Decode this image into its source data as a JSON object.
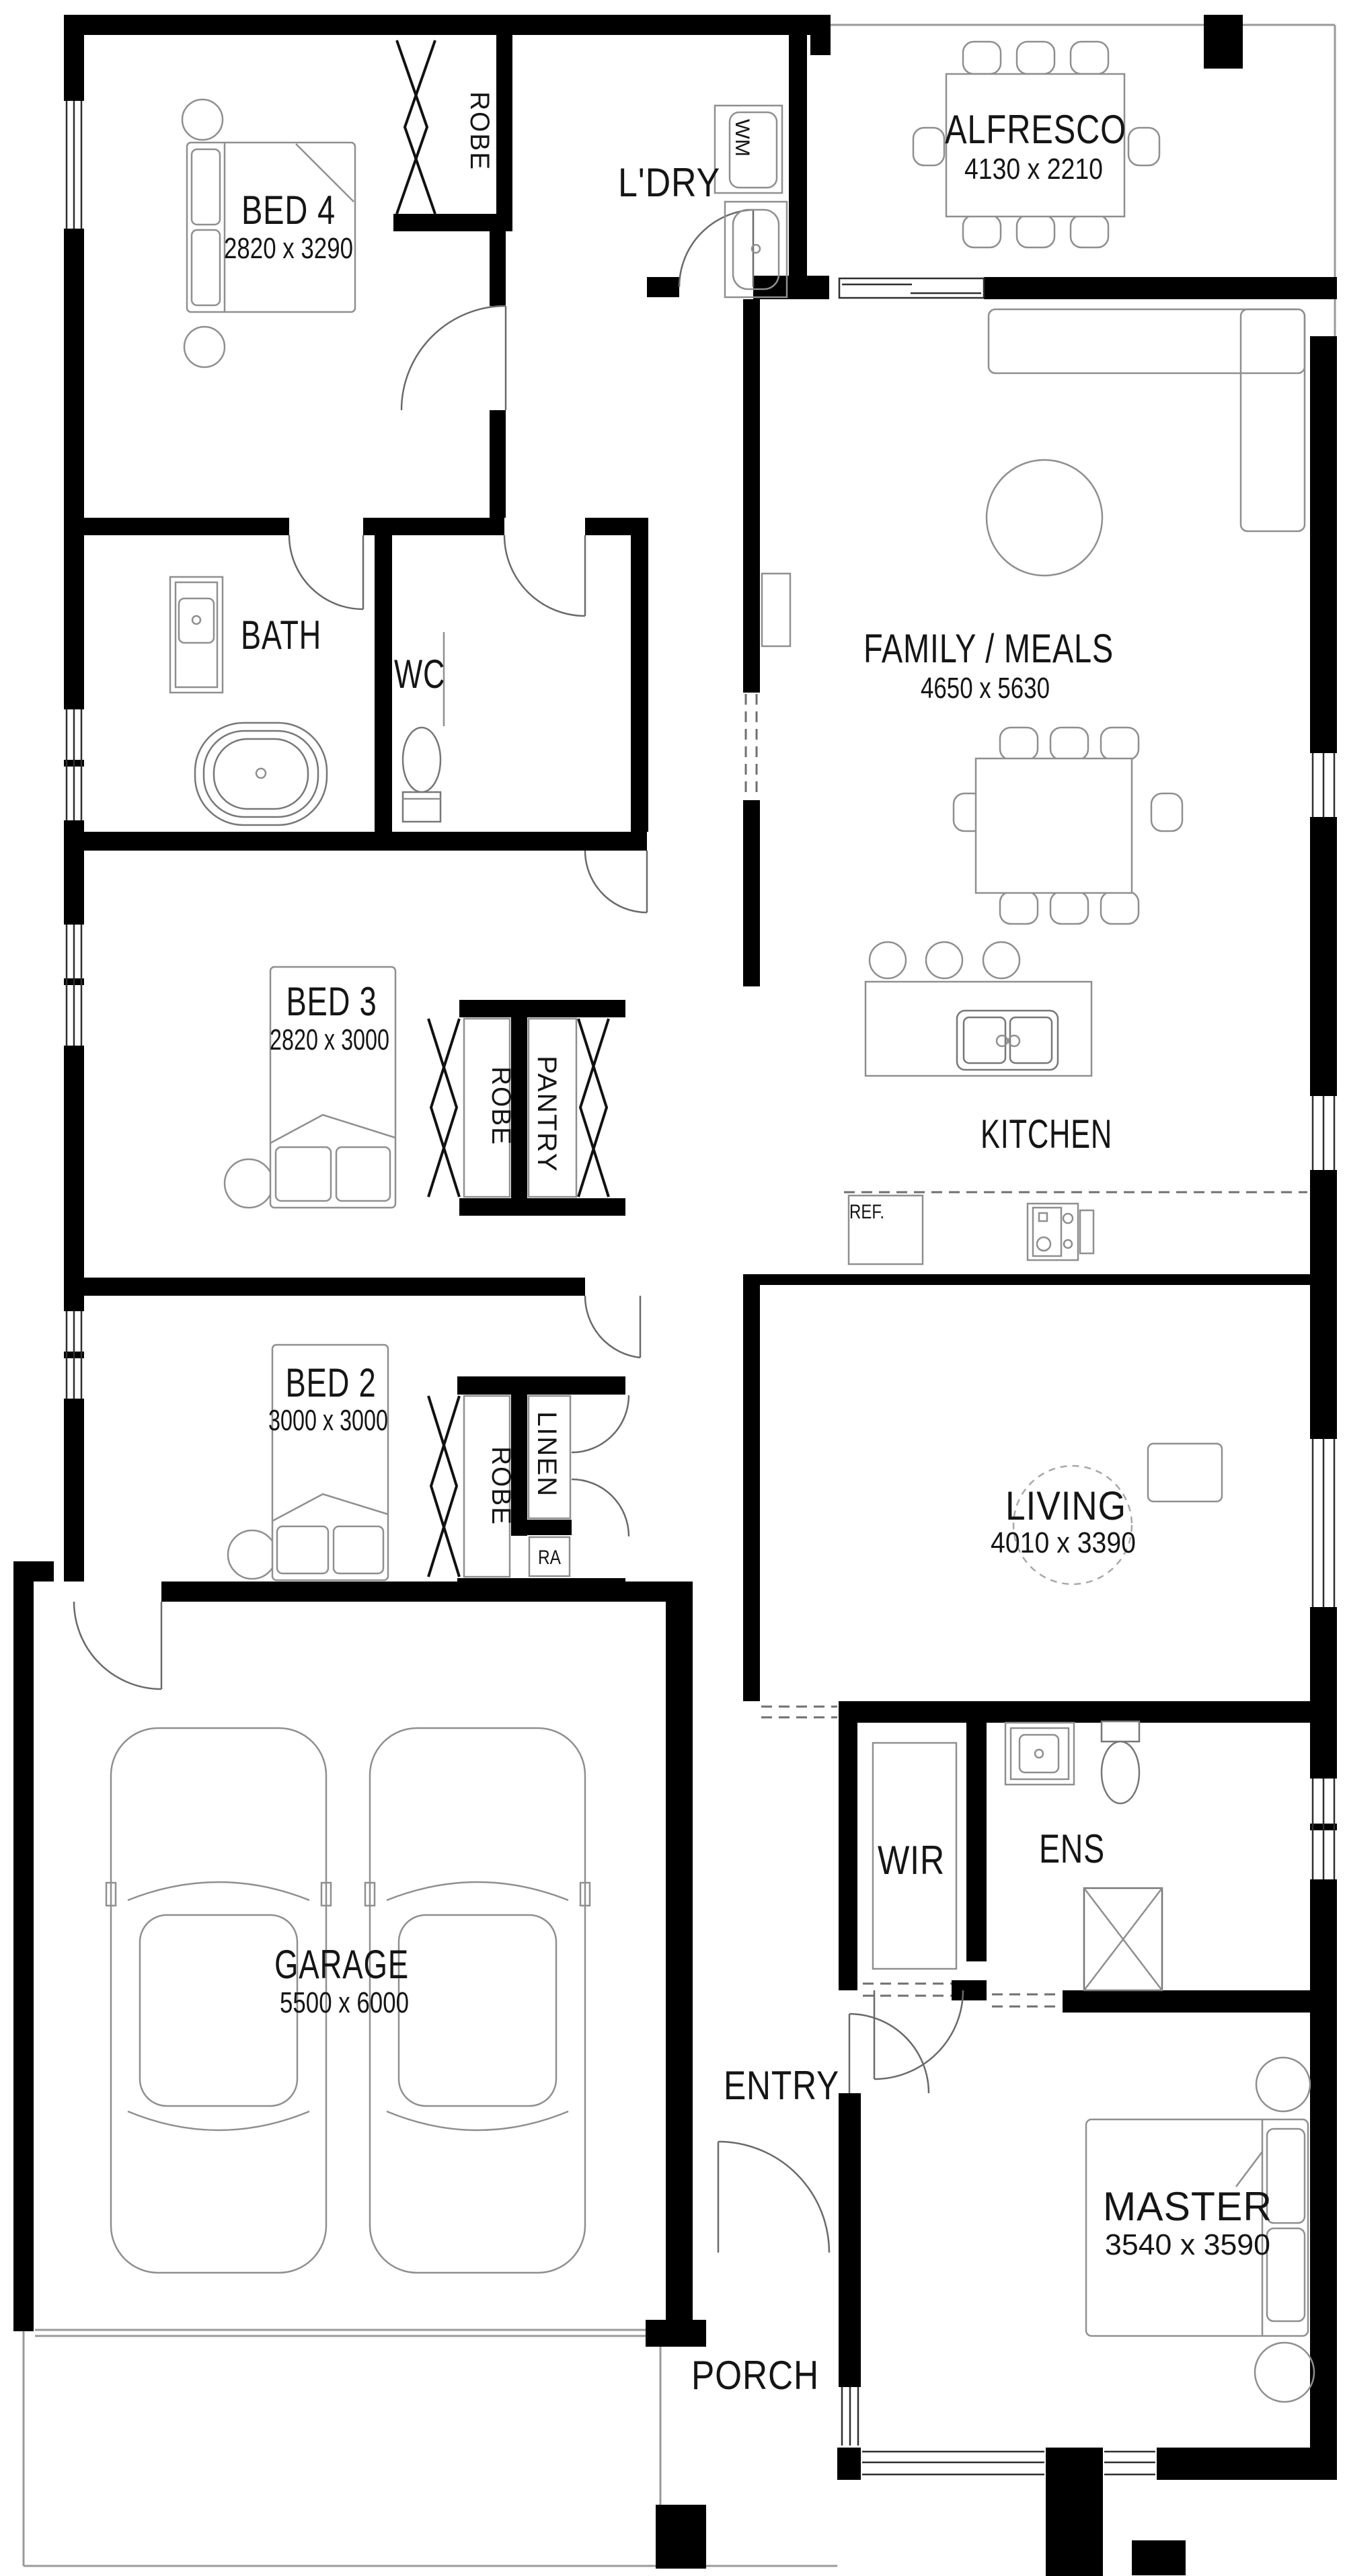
{
  "plan_title": "Single storey house floor plan",
  "colors": {
    "wall": "#000000",
    "background": "#ffffff",
    "furniture_line": "#8f8f8f",
    "text": "#151515"
  },
  "labels": {
    "bed4": {
      "name": "BED 4",
      "dims": "2820 x 3290"
    },
    "ldry": {
      "name": "L'DRY"
    },
    "alfresco": {
      "name": "ALFRESCO",
      "dims": "4130 x 2210"
    },
    "family": {
      "name": "FAMILY / MEALS",
      "dims": "4650 x 5630"
    },
    "bath": {
      "name": "BATH"
    },
    "wc": {
      "name": "WC"
    },
    "bed3": {
      "name": "BED 3",
      "dims": "2820 x 3000"
    },
    "kitchen": {
      "name": "KITCHEN"
    },
    "bed2": {
      "name": "BED 2",
      "dims": "3000 x 3000"
    },
    "living": {
      "name": "LIVING",
      "dims": "4010 x 3390"
    },
    "garage": {
      "name": "GARAGE",
      "dims": "5500 x 6000"
    },
    "wir": {
      "name": "WIR"
    },
    "ens": {
      "name": "ENS"
    },
    "entry": {
      "name": "ENTRY"
    },
    "master": {
      "name": "MASTER",
      "dims": "3540 x 3590"
    },
    "porch": {
      "name": "PORCH"
    },
    "robe_bed4": {
      "name": "ROBE"
    },
    "robe_bed3": {
      "name": "ROBE"
    },
    "pantry": {
      "name": "PANTRY"
    },
    "robe_bed2": {
      "name": "ROBE"
    },
    "linen": {
      "name": "LINEN"
    },
    "ra": {
      "name": "RA"
    },
    "wm": {
      "name": "WM"
    },
    "ref": {
      "name": "REF."
    }
  }
}
